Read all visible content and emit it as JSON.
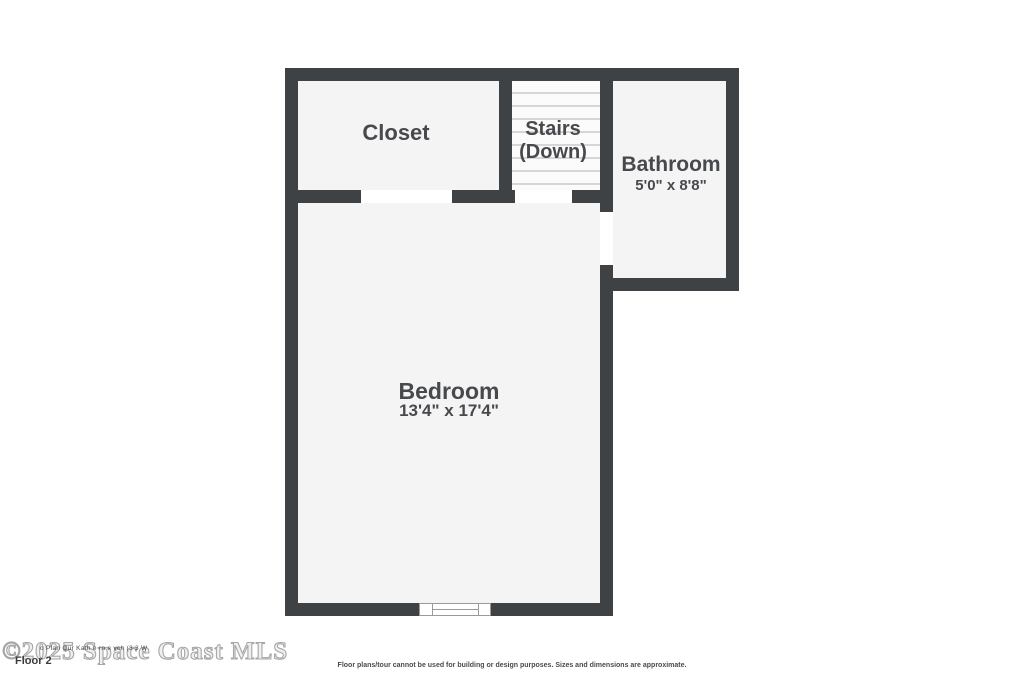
{
  "plan": {
    "rooms": {
      "closet": {
        "label": "Closet"
      },
      "stairs": {
        "label_line1": "Stairs",
        "label_line2": "(Down)"
      },
      "bathroom": {
        "label": "Bathroom",
        "dimensions": "5'0\" x 8'8\""
      },
      "bedroom": {
        "label": "Bedroom",
        "dimensions": "13'4\" x 17'4\""
      }
    }
  },
  "footer": {
    "watermark": "©2025 Space Coast MLS",
    "fine_print": "o Plan Qur Kath e rn e ych (3 3 W",
    "floor_label": "Floor 2",
    "disclaimer": "Floor plans/tour cannot be used for building or design purposes. Sizes and dimensions are approximate."
  },
  "colors": {
    "wall": "#3f4245",
    "room_fill": "#f4f4f4",
    "stairs_fill": "#fbfbfb",
    "tread_line": "#d6d6d6",
    "label_text": "#47494d",
    "watermark_outline": "#a6a6a6",
    "window_frame": "#9a9a9a"
  }
}
